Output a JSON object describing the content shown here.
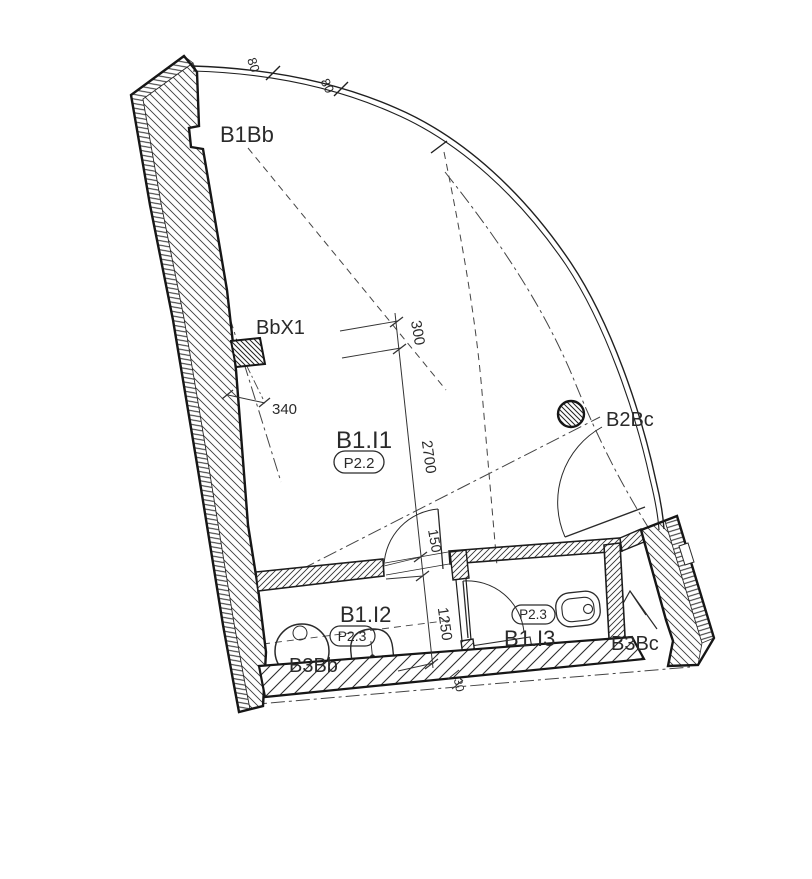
{
  "drawing": {
    "kind": "architectural-floor-plan"
  },
  "rooms": [
    {
      "label": "B1.I1",
      "tag": "P2.2"
    },
    {
      "label": "B1.I2",
      "tag": "P2.3"
    },
    {
      "label": "B1.I3",
      "tag": "P2.3"
    }
  ],
  "spaces": {
    "balcony": "B1Bb",
    "pier": "BbX1",
    "column": "B2Bc",
    "shaft_bath": "B3Bb",
    "shaft_wc": "B3Bc"
  },
  "dimensions": {
    "facade_seg_1": "80",
    "facade_seg_2": "80",
    "top_offset": "300",
    "room_depth": "2700",
    "door_gap": "150",
    "bath_depth": "1250",
    "pier_offset": "340",
    "slab_gap": "30"
  },
  "colors": {
    "background": "#ffffff",
    "line": "#1f1f1f",
    "text": "#2a2a2a"
  }
}
